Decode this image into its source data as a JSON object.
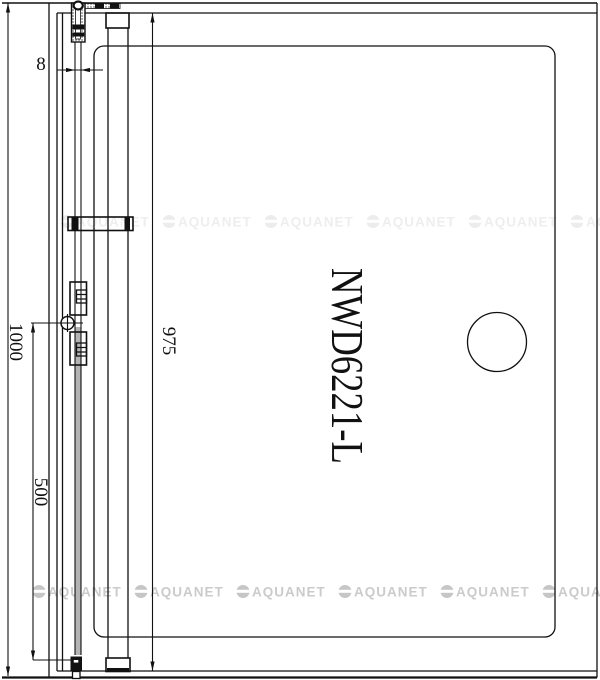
{
  "drawing": {
    "title": "NWD6221-L",
    "dimensions": {
      "overall": "1000",
      "lower_section": "500",
      "inner": "975",
      "glass_thickness": "8"
    },
    "watermark": {
      "text": "AQUANET"
    },
    "colors": {
      "line": "#111111",
      "glass": "#b4b4b4",
      "watermark": "#cbcbcb",
      "background": "#ffffff"
    }
  }
}
